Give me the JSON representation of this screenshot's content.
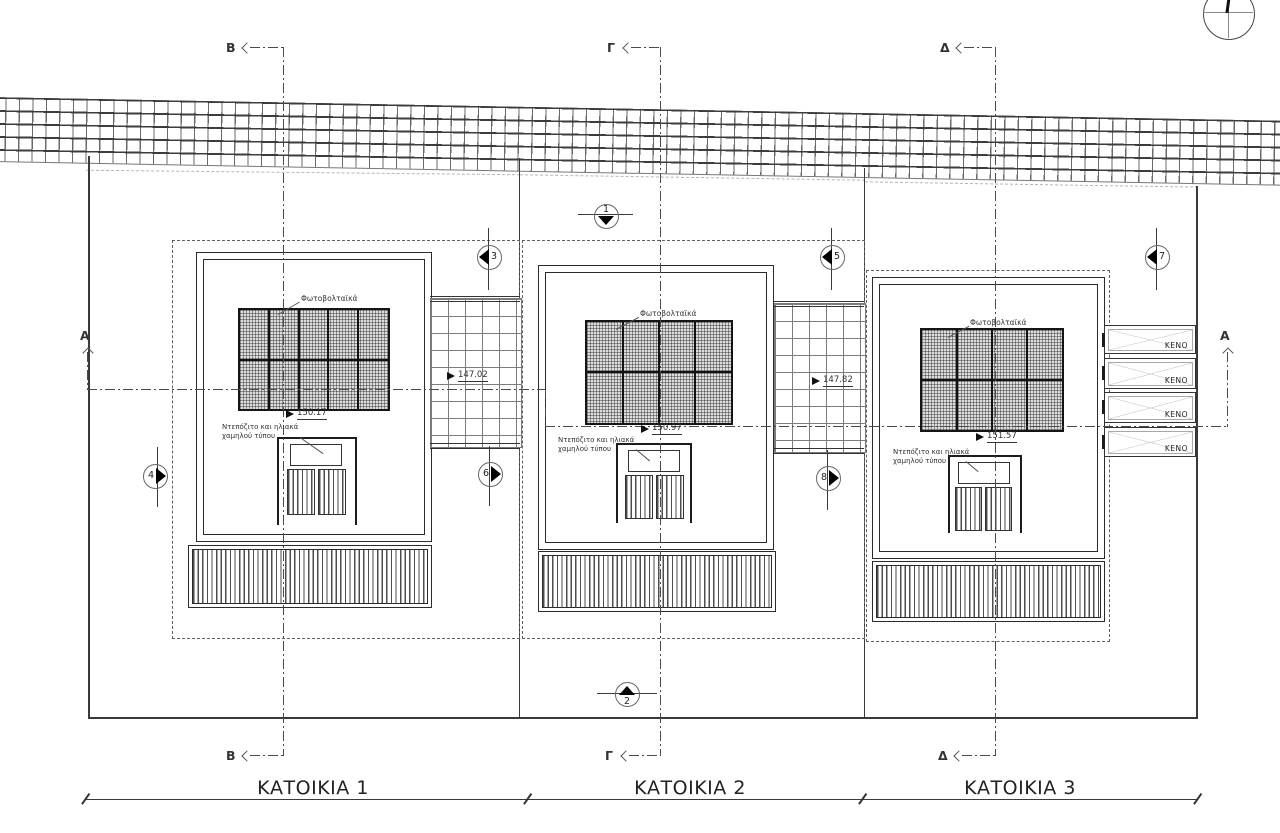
{
  "section_labels": {
    "a": "A",
    "b": "B",
    "g": "Γ",
    "d": "Δ"
  },
  "view_markers": {
    "m1": "1",
    "m2": "2",
    "m3": "3",
    "m4": "4",
    "m5": "5",
    "m6": "6",
    "m7": "7",
    "m8": "8"
  },
  "houses": [
    {
      "title": "ΚΑΤΟΙΚΙΑ 1",
      "pv_label": "Φωτοβολταϊκά",
      "roof_level": "150.17",
      "equip_line1": "Ντεπόζιτο και ηλιακά",
      "equip_line2": "χαμηλού τύπου"
    },
    {
      "title": "ΚΑΤΟΙΚΙΑ 2",
      "pv_label": "Φωτοβολταϊκά",
      "roof_level": "150.97",
      "equip_line1": "Ντεπόζιτο και ηλιακά",
      "equip_line2": "χαμηλού τύπου"
    },
    {
      "title": "ΚΑΤΟΙΚΙΑ 3",
      "pv_label": "Φωτοβολταϊκά",
      "roof_level": "151.57",
      "equip_line1": "Ντεπόζιτο και ηλιακά",
      "equip_line2": "χαμηλού τύπου"
    }
  ],
  "terraces": [
    {
      "level": "147.02"
    },
    {
      "level": "147.82"
    }
  ],
  "voids": [
    {
      "label": "KENO"
    },
    {
      "label": "KENO"
    },
    {
      "label": "KENO"
    },
    {
      "label": "KENO"
    }
  ],
  "colors": {
    "line": "#2f2f2f",
    "grid": "#7d7d7d",
    "hatch": "#4e4e4e"
  }
}
